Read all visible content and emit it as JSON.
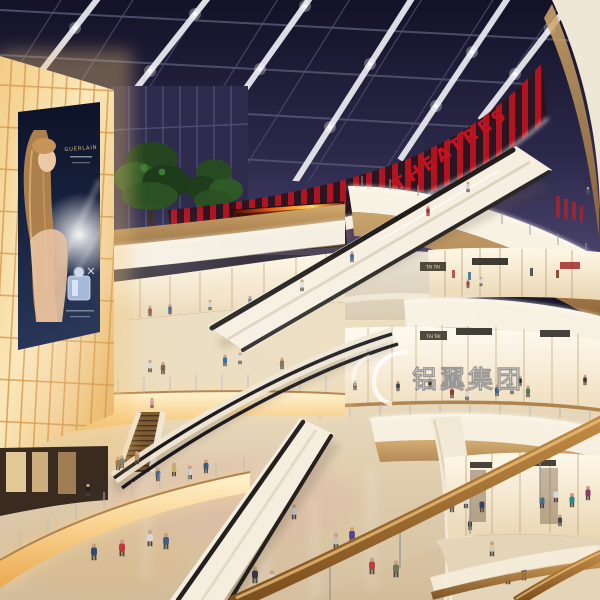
{
  "meta": {
    "title": "Shopping mall atrium interior rendering (evening)"
  },
  "scene": {
    "setting": "multi-level shopping mall atrium with glass skylight roof, curved balconies, escalators and shoppers",
    "signs": {
      "theatres": "THEATRES",
      "store_tai_tai_upper": "TAI TAI",
      "store_tai_tai_lower": "TAI TAI"
    },
    "billboard": {
      "brand": "GUERLAIN"
    },
    "watermark": {
      "text": "铝翼集团"
    },
    "palette": {
      "sky_navy": "#16152b",
      "sky_violet": "#46406a",
      "theatre_red": "#bd1220",
      "fascia_cream": "#f8f2e3",
      "wood": "#b07f42",
      "glow_amber": "#f0b55e",
      "floor_beige": "#d7c1a1",
      "fire_screen_orange": "#ff9026"
    }
  }
}
